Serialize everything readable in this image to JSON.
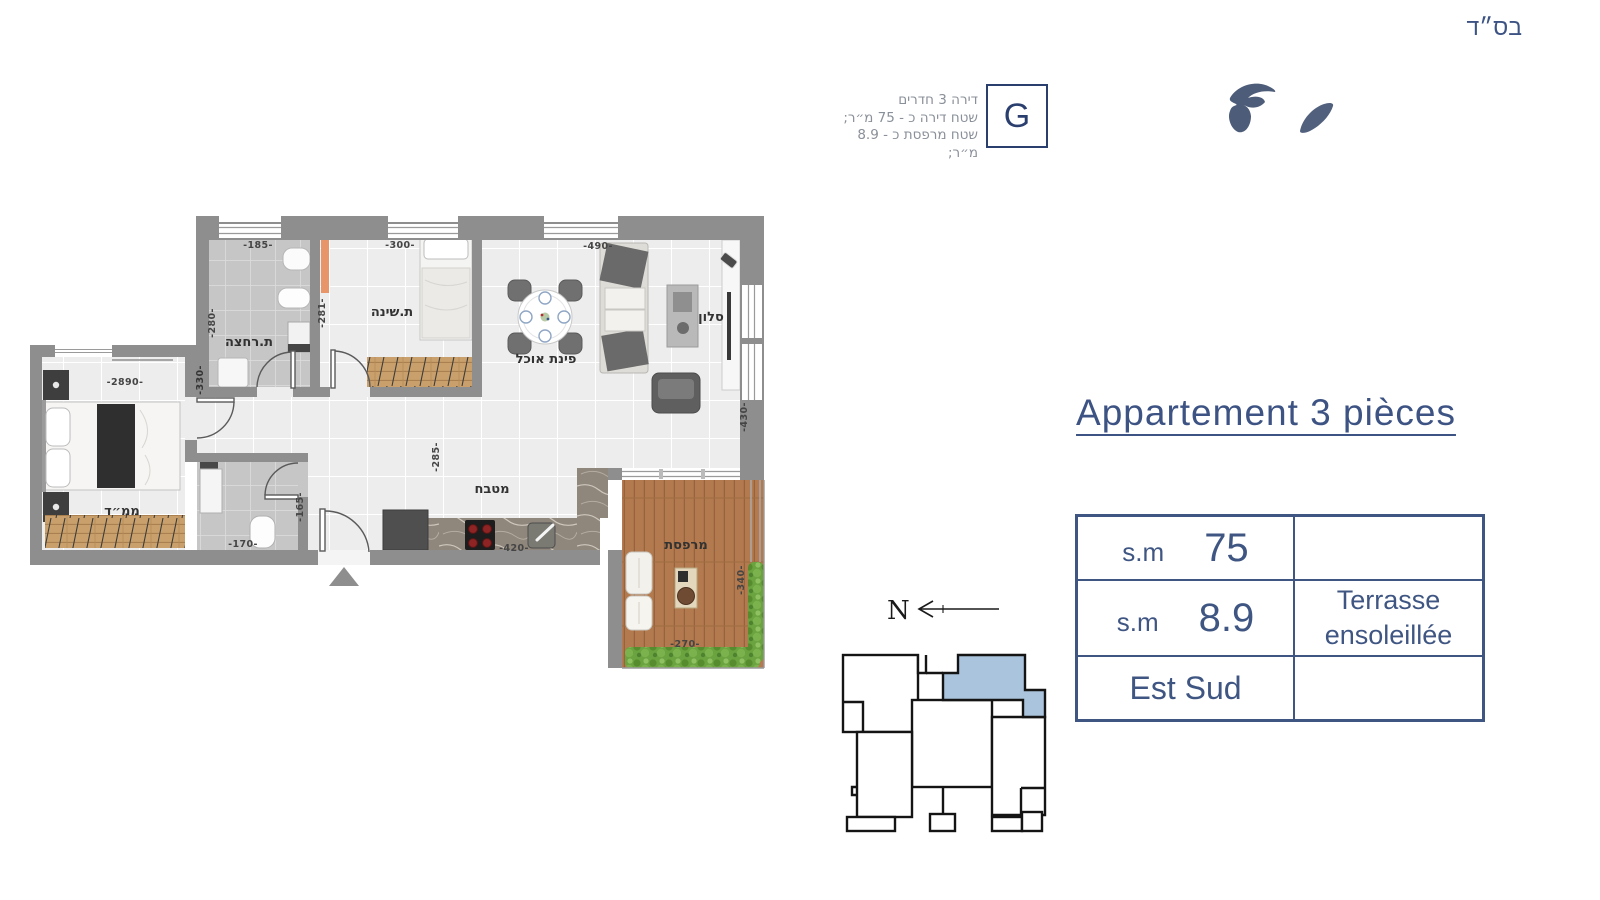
{
  "bsd": "בס״ד",
  "header": {
    "lines": [
      "דירה 3 חדרים",
      "שטח דירה כ - 75 מ״ר;",
      "שטח מרפסת כ - 8.9 מ״ר;"
    ],
    "unit_letter": "G"
  },
  "title": "Appartement 3 pièces",
  "table": {
    "r1_label": "s.m",
    "r1_value": "75",
    "r1_note": "",
    "r2_label": "s.m",
    "r2_value": "8.9",
    "r2_note_line1": "Terrasse",
    "r2_note_line2": "ensoleillée",
    "r3_label": "Est Sud",
    "r3_note": ""
  },
  "north_label": "N",
  "floorplan": {
    "rooms": {
      "bathroom": "ת.רחצה",
      "bedroom": "ת.שינה",
      "dining": "פינת אוכל",
      "salon": "סלון",
      "kitchen": "מטבח",
      "mamad": "ממ״ד",
      "terrace": "מרפסת"
    },
    "dims": {
      "bath_w": "-185-",
      "bed_w": "-300-",
      "salon_w": "-490-",
      "bath_h": "-280-",
      "bed_h": "-281-",
      "left_wall": "-330-",
      "mamad_w": "-2890-",
      "wc_w": "-170-",
      "wc_h": "-165-",
      "hall_h": "-285-",
      "kitchen_w": "-420-",
      "salon_h": "-430-",
      "terrace_h": "-340-",
      "terrace_w": "-270-"
    }
  },
  "colors": {
    "accent": "#3f5683",
    "wall": "#8e8e8e",
    "highlight_unit": "#a9c4dc",
    "deck_wood": "#b27a4e",
    "greenery": "#6aa33f"
  }
}
